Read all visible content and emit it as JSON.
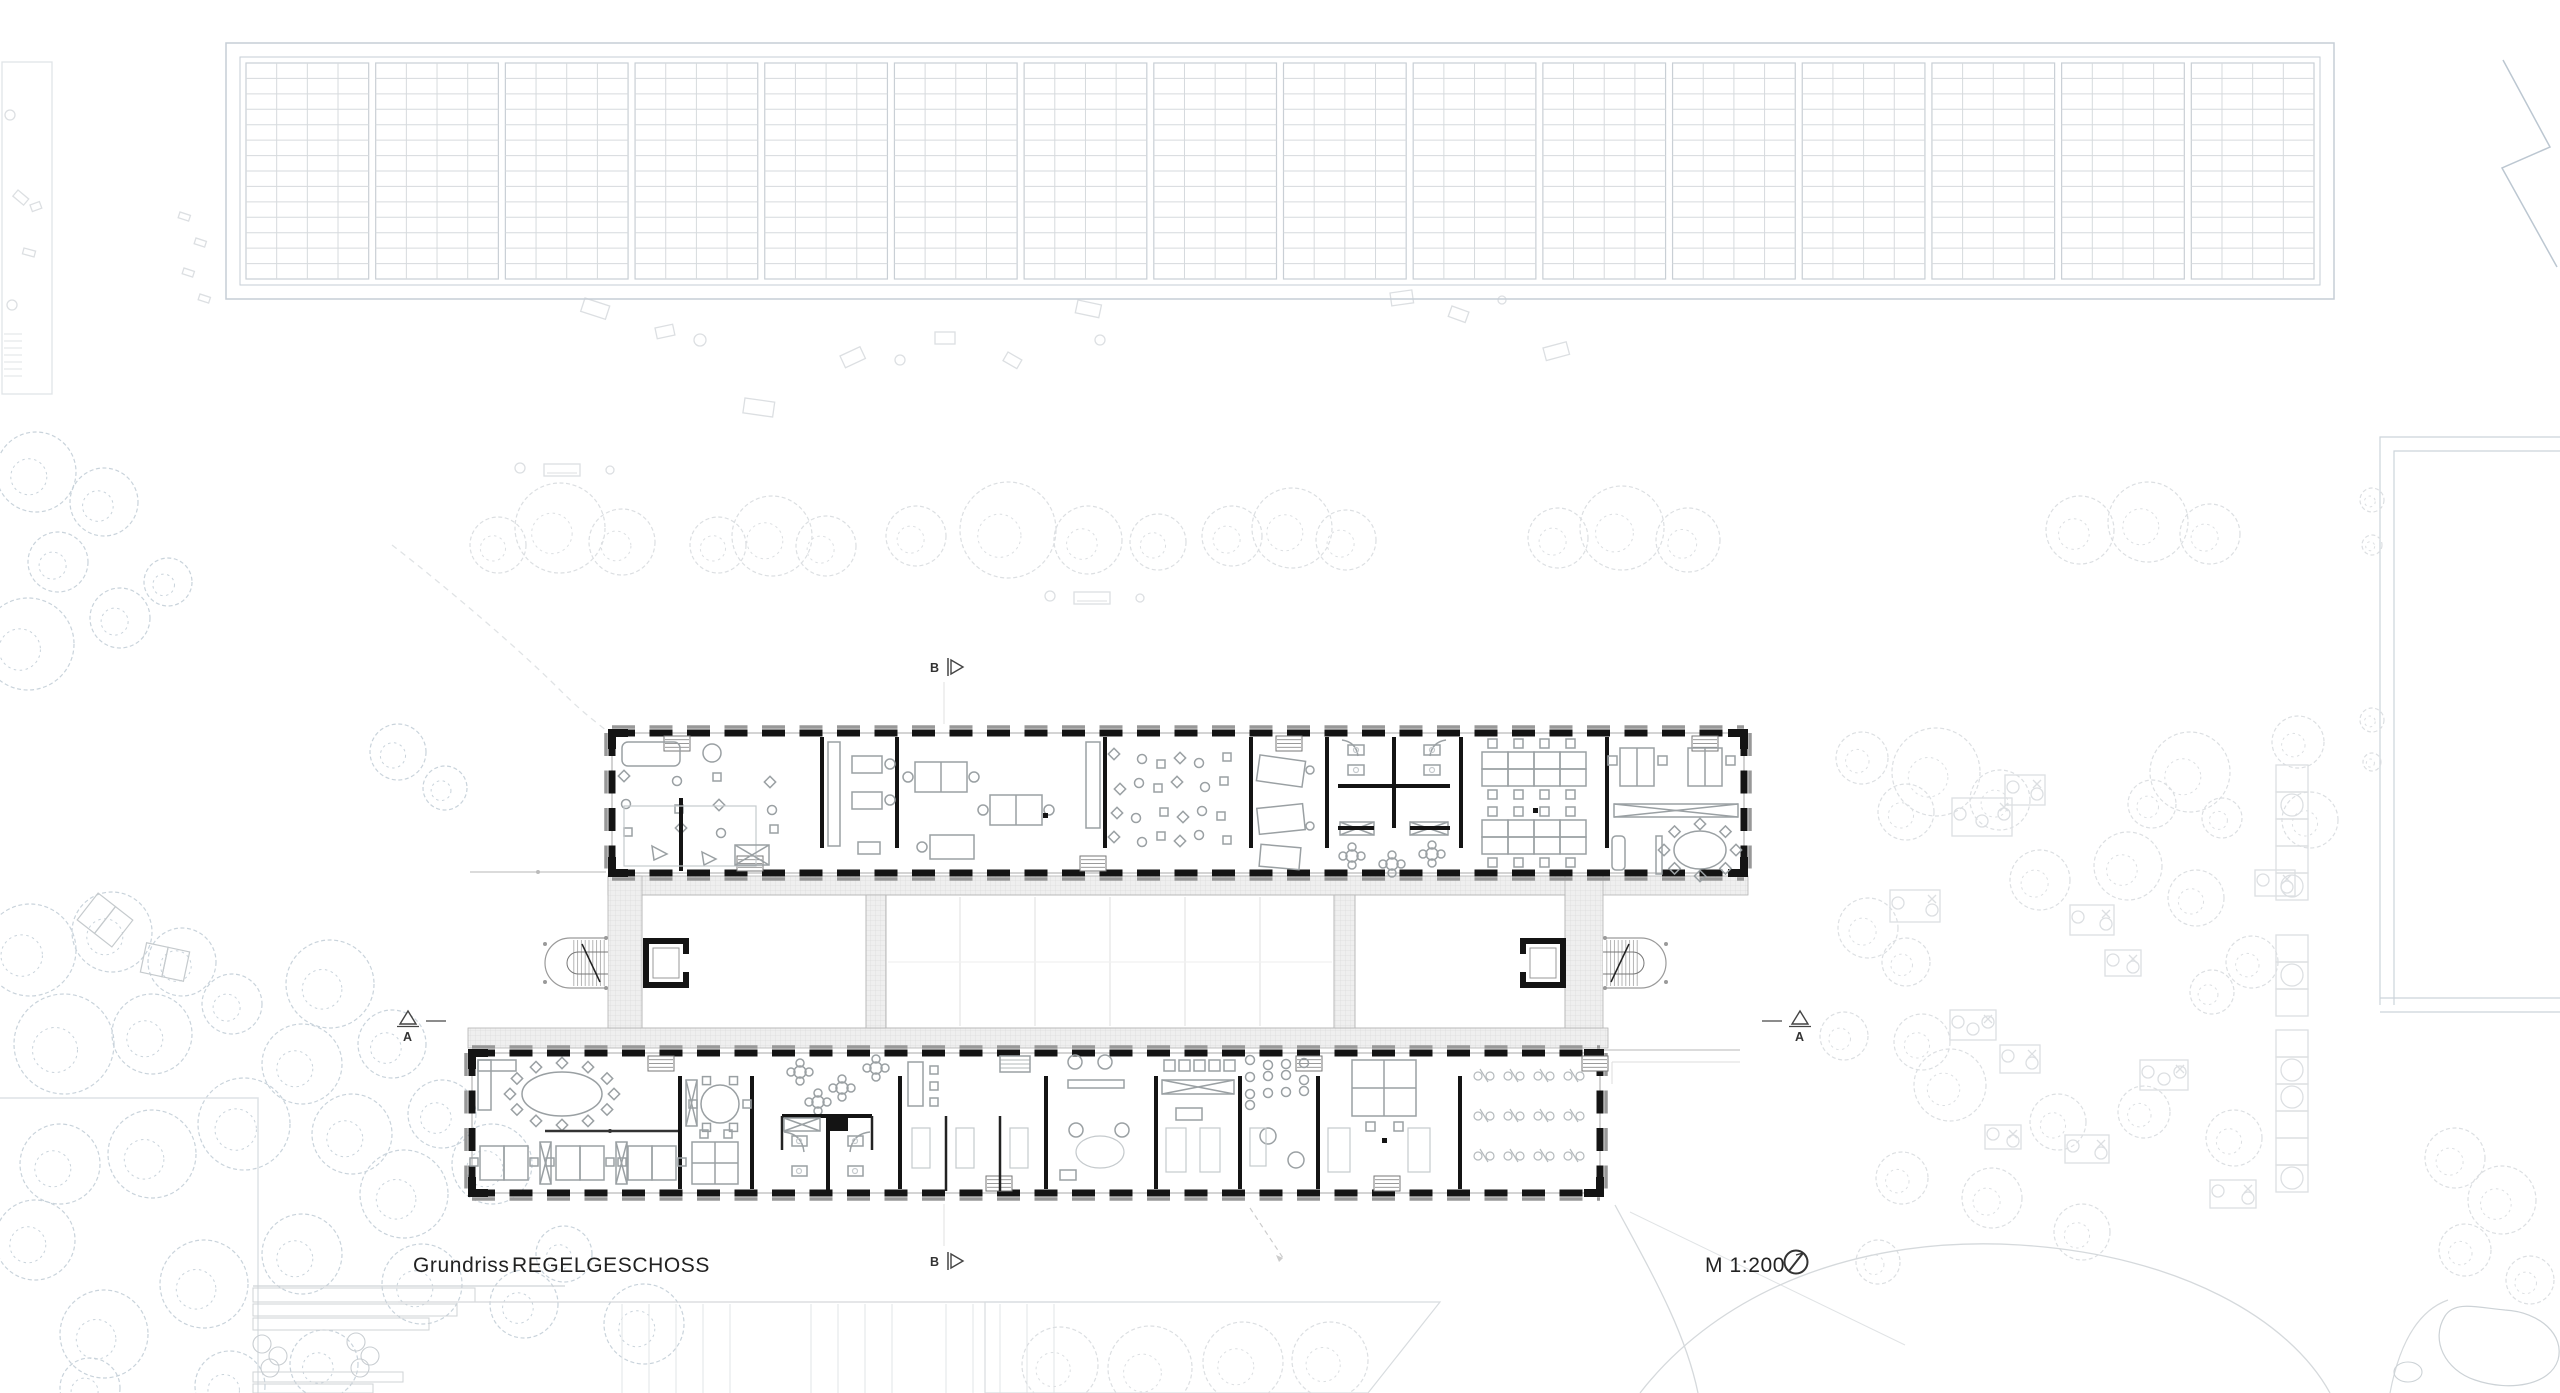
{
  "drawing": {
    "title_label": "Grundriss",
    "title_value": "REGELGESCHOSS",
    "scale_label": "M 1:200"
  },
  "annotations": {
    "section_a": "A",
    "section_b": "B"
  },
  "icons": {
    "north_indicator": "compass-circle-with-needle"
  },
  "pergola": {
    "bays": 16,
    "cols_per_bay": 4,
    "rows": 14
  },
  "colors": {
    "paper": "#ffffff",
    "ink": "#141414",
    "furniture": "#9aa0a3",
    "site_light": "#dcdfe2",
    "site_blue": "#c9d3db",
    "pergola_frame": "#c6ced6",
    "pergola_grid": "#d6dadd",
    "corridor_fill": "#efefef",
    "corridor_grid": "#dbdbdb",
    "sill_gray": "#989898"
  }
}
